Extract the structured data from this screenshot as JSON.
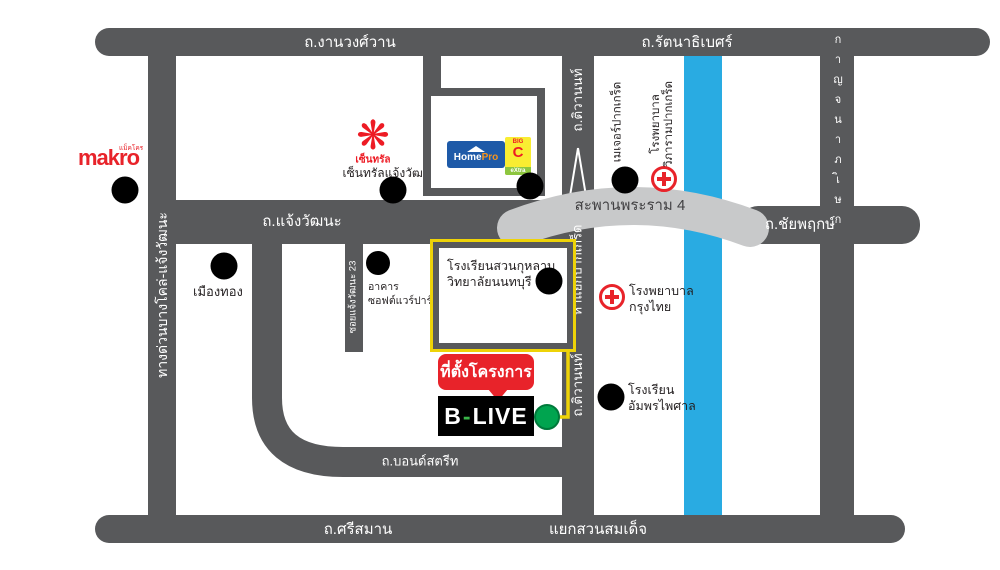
{
  "roads": {
    "ngamwongwan": "ถ.งานวงศ์วาน",
    "rattanathibet": "ถ.รัตนาธิเบศร์",
    "expressway": "ทางด่วนบางโคล่-แจ้งวัฒนะ",
    "chaengwatthana": "ถ.แจ้งวัฒนะ",
    "tiwanon_top": "ถ.ติวานนท์",
    "ha_yaek_pakkret": "ห้าแยกปากเกร็ด",
    "tiwanon_bottom": "ถ.ติวานนท์",
    "soi23": "ซอยแจ้งวัฒนะ 23",
    "bond_street": "ถ.บอนด์สตรีท",
    "srisaman": "ถ.ศรีสมาน",
    "suan_somdet_junction": "แยกสวนสมเด็จ",
    "chaiyaphruek": "ถ.ชัยพฤกษ์",
    "kanchanaphisek": "กาญจนาภิเษก",
    "rama4_bridge": "สะพานพระราม 4"
  },
  "pois": {
    "makro": {
      "brand": "makro",
      "brand_sub": "แม็คโคร"
    },
    "central": {
      "brand": "เซ็นทรัล",
      "label": "เซ็นทรัลแจ้งวัฒนะ"
    },
    "homepro": {
      "home": "Home",
      "pro": "Pro"
    },
    "bigc": {
      "big": "BIG",
      "c": "C",
      "extra": "eXtra"
    },
    "muang_thong": "เมืองทอง",
    "software_park": "อาคาร\nซอฟต์แวร์ปาร์ค",
    "suankularb_school": "โรงเรียนสวนกุหลาบ\nวิทยาลัยนนทบุรี",
    "major_pakkret": "เมเจอร์ปากเกร็ด",
    "vipharam_hospital": "โรงพยาบาล\nวิภารามปากเกร็ด",
    "krungthai_hospital": "โรงพยาบาล\nกรุงไทย",
    "amphon_phaisan_school": "โรงเรียน\nอัมพรไพศาล"
  },
  "project": {
    "callout": "ที่ตั้งโครงการ",
    "brand_b": "B",
    "brand_dash": "-",
    "brand_live": "LIVE"
  },
  "colors": {
    "road_gray": "#58595b",
    "bridge_gray": "#c8c9ca",
    "river_blue": "#29abe2",
    "route_yellow": "#eed308",
    "accent_red": "#e8232a",
    "brand_green": "#00a44f"
  }
}
